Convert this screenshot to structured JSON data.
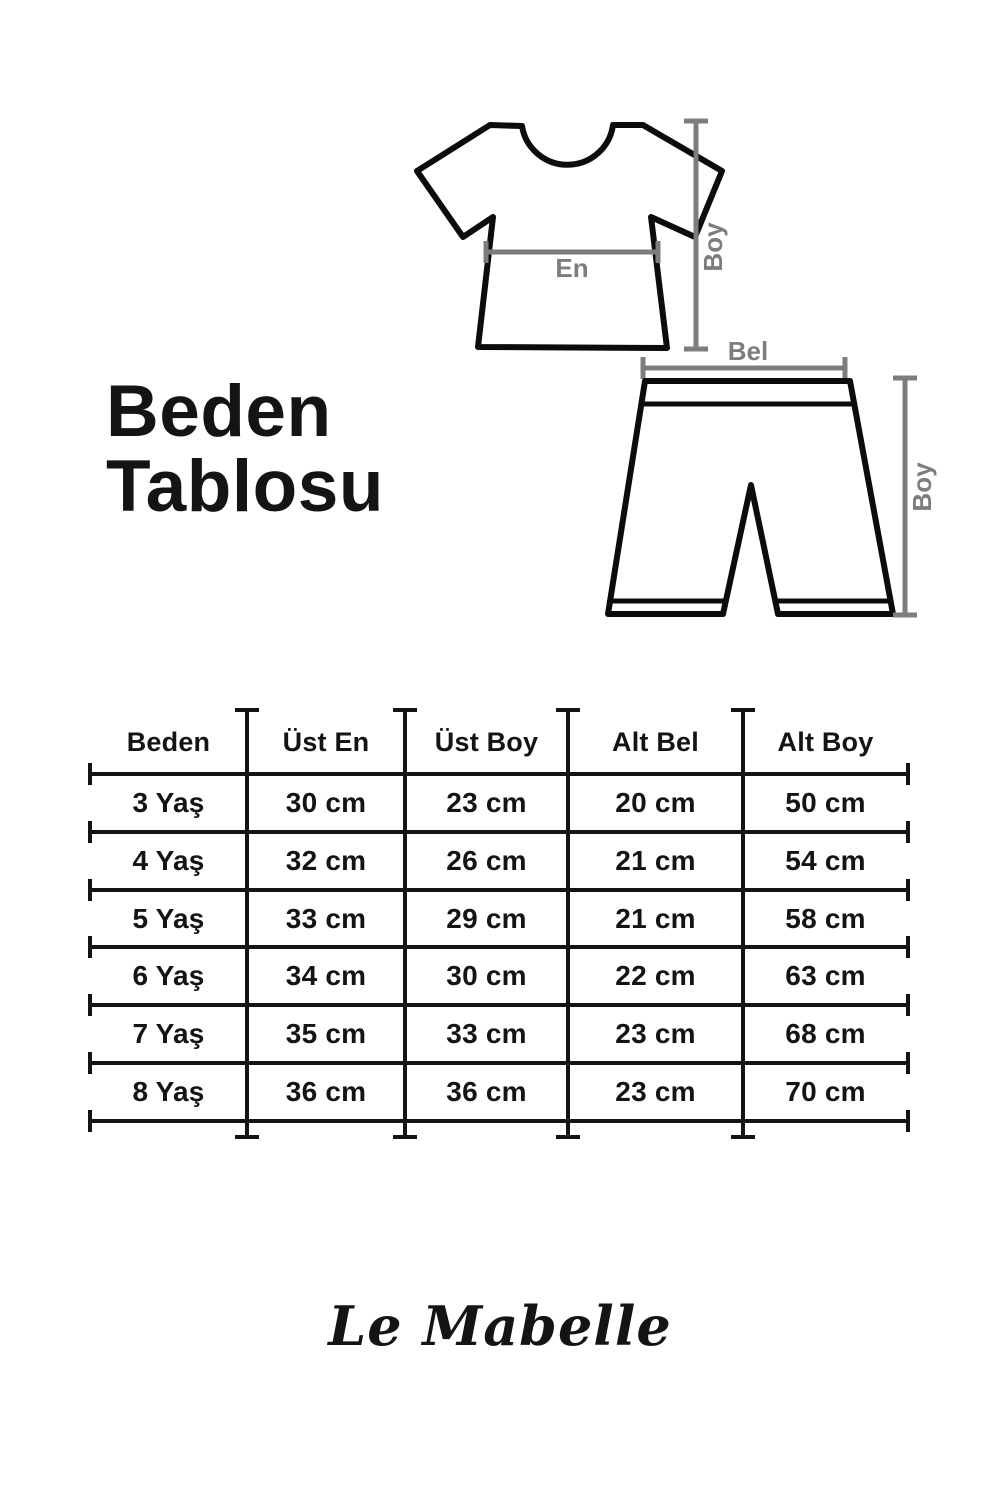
{
  "page": {
    "background": "#ffffff",
    "ink_color": "#141414",
    "measure_line_color": "#7d7d7d"
  },
  "title": {
    "line1": "Beden",
    "line2": "Tablosu"
  },
  "diagram": {
    "tshirt_width_label": "En",
    "tshirt_height_label": "Boy",
    "shorts_waist_label": "Bel",
    "shorts_height_label": "Boy"
  },
  "size_table": {
    "headers": [
      "Beden",
      "Üst En",
      "Üst Boy",
      "Alt Bel",
      "Alt Boy"
    ],
    "rows": [
      {
        "cells": [
          "3 Yaş",
          "30 cm",
          "23 cm",
          "20 cm",
          "50 cm"
        ]
      },
      {
        "cells": [
          "4 Yaş",
          "32 cm",
          "26 cm",
          "21 cm",
          "54 cm"
        ]
      },
      {
        "cells": [
          "5 Yaş",
          "33 cm",
          "29 cm",
          "21 cm",
          "58 cm"
        ]
      },
      {
        "cells": [
          "6 Yaş",
          "34 cm",
          "30 cm",
          "22 cm",
          "63 cm"
        ]
      },
      {
        "cells": [
          "7 Yaş",
          "35 cm",
          "33 cm",
          "23 cm",
          "68 cm"
        ]
      },
      {
        "cells": [
          "8 Yaş",
          "36 cm",
          "36 cm",
          "23 cm",
          "70 cm"
        ]
      }
    ]
  },
  "brand": {
    "logo_text": "Le Mabelle"
  }
}
